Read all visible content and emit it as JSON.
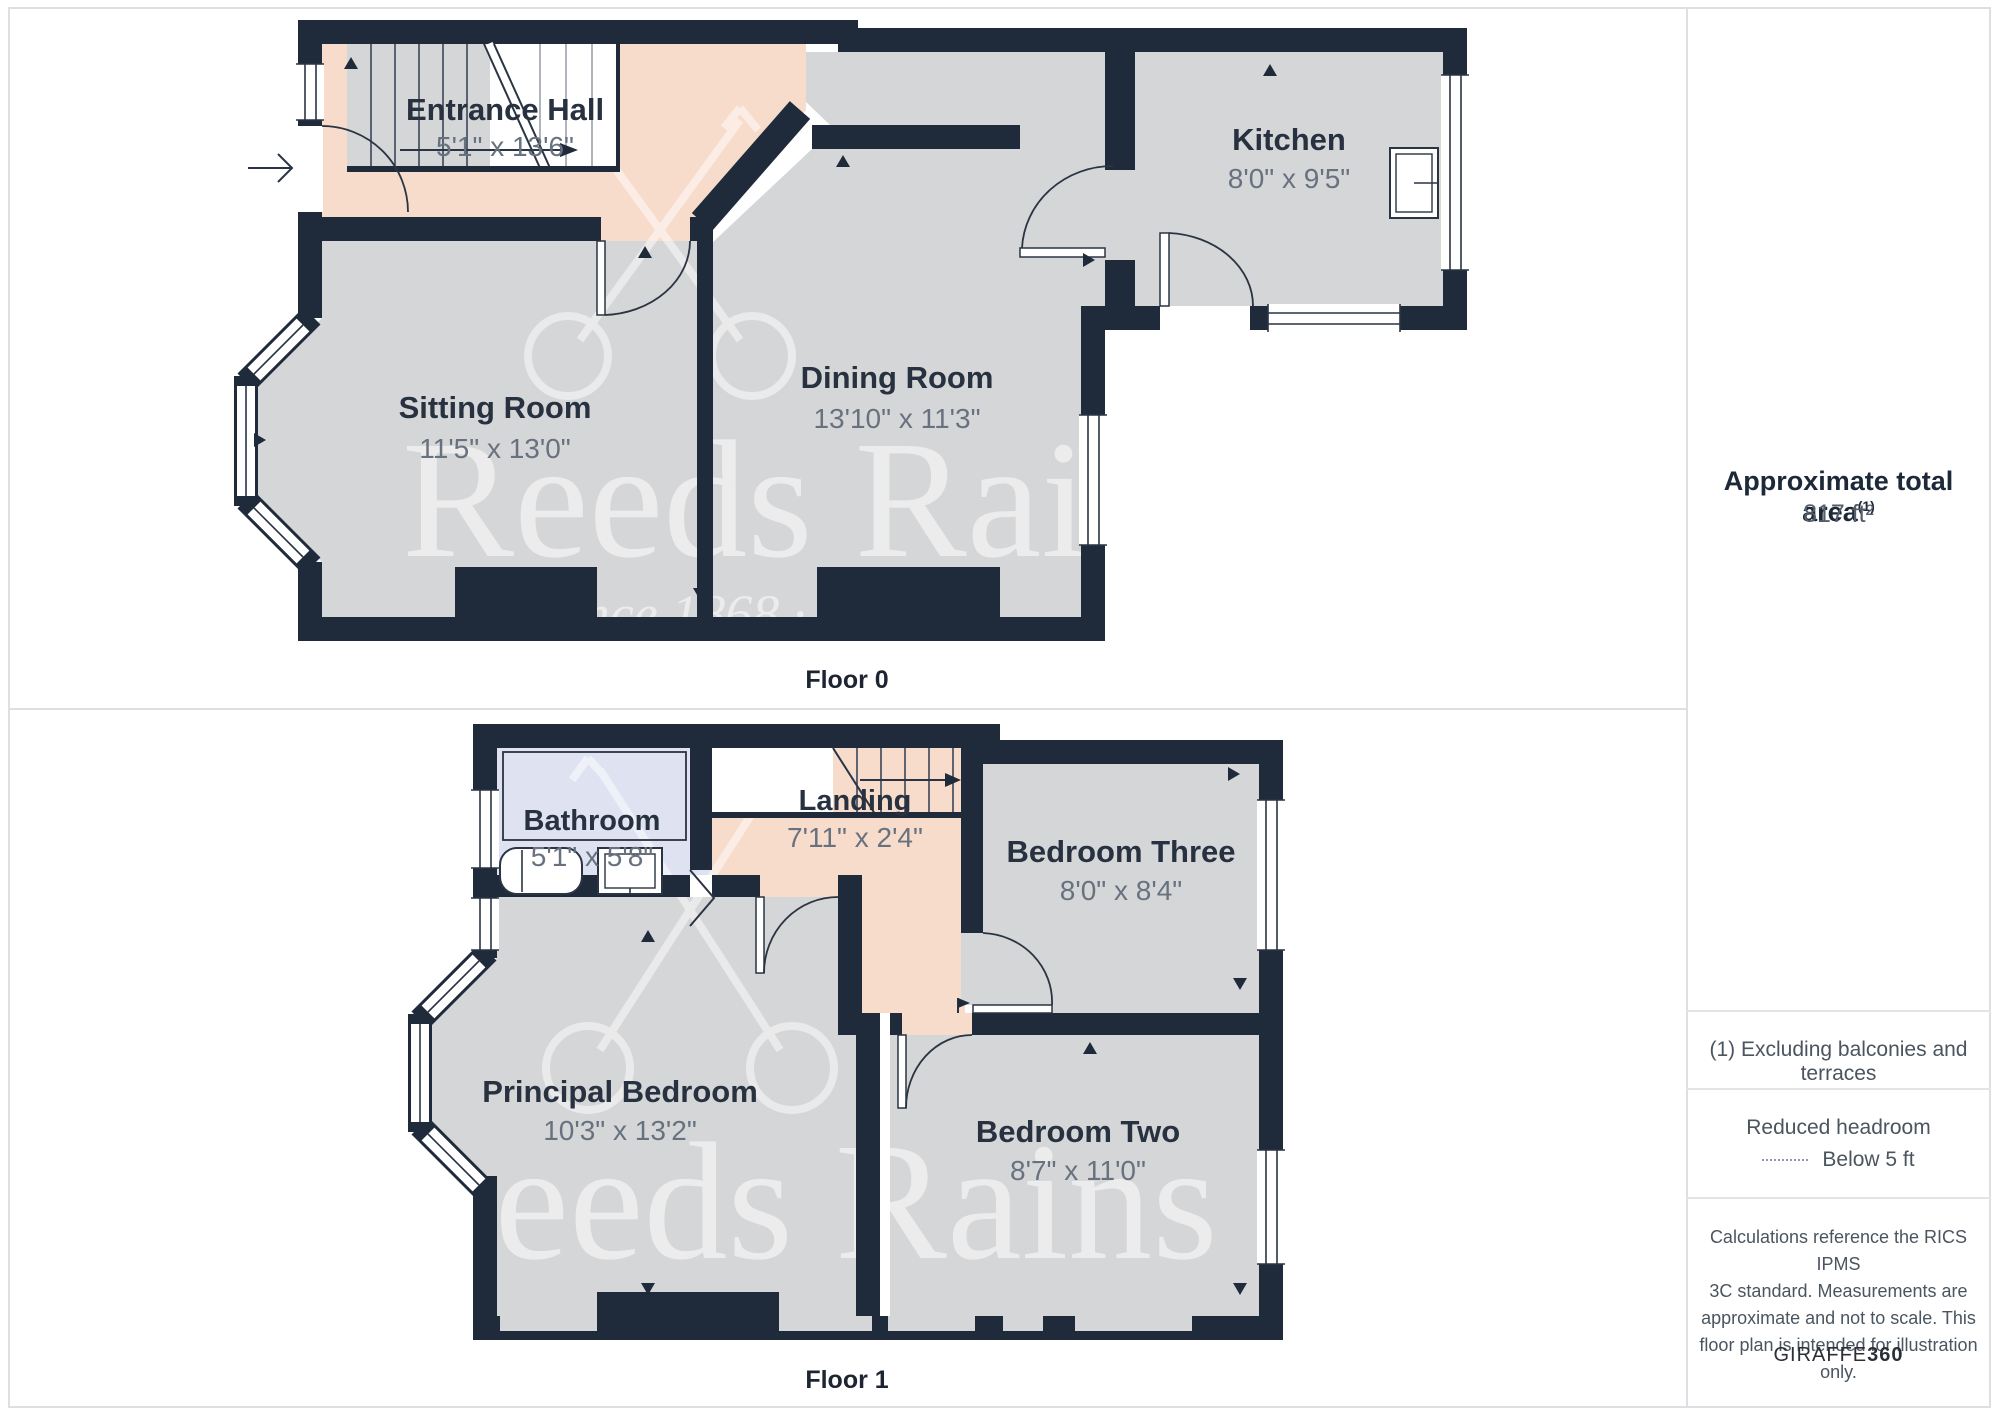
{
  "floors": [
    {
      "caption": "Floor 0",
      "rooms": [
        {
          "name": "Entrance Hall",
          "dims": "5'1\" x 13'6\""
        },
        {
          "name": "Sitting Room",
          "dims": "11'5\" x 13'0\""
        },
        {
          "name": "Dining Room",
          "dims": "13'10\" x 11'3\""
        },
        {
          "name": "Kitchen",
          "dims": "8'0\" x 9'5\""
        }
      ]
    },
    {
      "caption": "Floor 1",
      "rooms": [
        {
          "name": "Bathroom",
          "dims": "5'1\" x 5'8\""
        },
        {
          "name": "Landing",
          "dims": "7'11\" x 2'4\""
        },
        {
          "name": "Bedroom Three",
          "dims": "8'0\" x 8'4\""
        },
        {
          "name": "Principal Bedroom",
          "dims": "10'3\" x 13'2\""
        },
        {
          "name": "Bedroom Two",
          "dims": "8'7\" x 11'0\""
        }
      ]
    }
  ],
  "watermark": {
    "name_full": "Reeds Rains",
    "name_partial": "Reeds Rai",
    "tagline": "· Since 1868 ·"
  },
  "sidebar": {
    "area_title": "Approximate total area",
    "area_note_ref": "(1)",
    "area_value": "817 ft²",
    "note": "(1) Excluding balconies and terraces",
    "legend_title": "Reduced headroom",
    "legend_item": "Below 5 ft",
    "disclaimer_lines": [
      "Calculations reference the RICS IPMS",
      "3C standard. Measurements are",
      "approximate and not to scale. This",
      "floor plan is intended for illustration",
      "only."
    ],
    "brand": "GIRAFFE",
    "brand_suffix": "360"
  },
  "colors": {
    "wall": "#1f2b3a",
    "floor": "#d5d6d8",
    "hall": "#f7dccb",
    "bathroom": "#dfe3f1",
    "border": "#dddfe2"
  }
}
